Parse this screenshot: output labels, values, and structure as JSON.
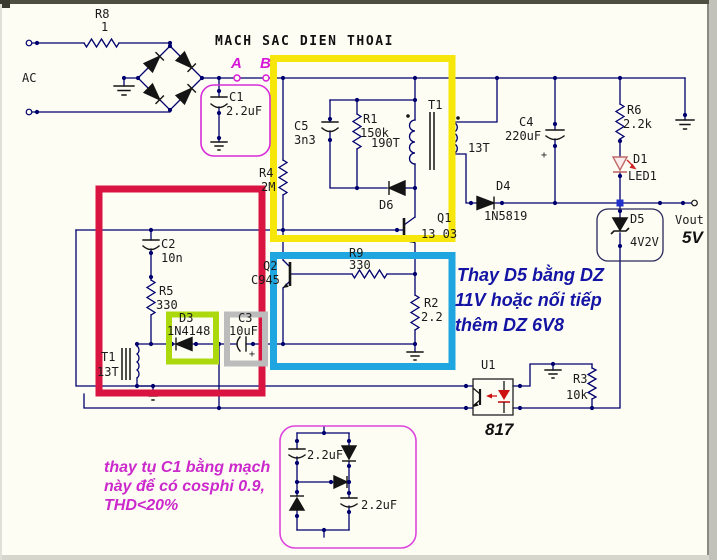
{
  "title": "MACH SAC DIEN THOAI",
  "labels": {
    "ac": "AC",
    "node_a": "A",
    "node_b": "B",
    "vout": "Vout",
    "vout_value": "5V"
  },
  "components": {
    "r8": {
      "ref": "R8",
      "value": "1"
    },
    "c1": {
      "ref": "C1",
      "value": "2.2uF"
    },
    "c5": {
      "ref": "C5",
      "value": "3n3"
    },
    "r1": {
      "ref": "R1",
      "value": "150k"
    },
    "r4": {
      "ref": "R4",
      "value": "2M"
    },
    "d6": {
      "ref": "D6"
    },
    "t1": {
      "ref": "T1",
      "primary_turns": "190T",
      "secondary_turns": "13T"
    },
    "q1": {
      "ref": "Q1",
      "part": "13 03"
    },
    "c4": {
      "ref": "C4",
      "value": "220uF",
      "polarity": "+"
    },
    "r6": {
      "ref": "R6",
      "value": "2.2k"
    },
    "d1": {
      "ref": "D1",
      "part": "LED1"
    },
    "d4": {
      "ref": "D4",
      "part": "1N5819"
    },
    "d5": {
      "ref": "D5",
      "part": "4V2V"
    },
    "c2": {
      "ref": "C2",
      "value": "10n"
    },
    "r5": {
      "ref": "R5",
      "value": "330"
    },
    "q2": {
      "ref": "Q2",
      "part": "C945"
    },
    "d3": {
      "ref": "D3",
      "part": "1N4148"
    },
    "c3": {
      "ref": "C3",
      "value": "10uF",
      "polarity": "+"
    },
    "t1_feedback": {
      "ref": "T1",
      "turns": "13T"
    },
    "r9": {
      "ref": "R9",
      "value": "330"
    },
    "r2": {
      "ref": "R2",
      "value": "2.2"
    },
    "u1": {
      "ref": "U1",
      "part": "817"
    },
    "r3": {
      "ref": "R3",
      "value": "10k"
    },
    "vf_cap_top": {
      "value": "2.2uF"
    },
    "vf_cap_bottom": {
      "value": "2.2uF"
    }
  },
  "annotations": {
    "blue_note": {
      "lines": [
        "Thay D5 bằng DZ",
        "11V hoặc nối tiếp",
        "thêm DZ 6V8"
      ],
      "color": "#1414a4"
    },
    "magenta_note": {
      "lines": [
        "thay tụ C1 bằng mạch",
        "này để có cosphi 0.9,",
        "THD<20%"
      ],
      "color": "#cc29cc"
    }
  },
  "colors": {
    "wire": "#00006e",
    "highlight_yellow": "#f6e60a",
    "highlight_red": "#da1440",
    "highlight_blue": "#1fa6e0",
    "highlight_green": "#abd90e",
    "highlight_gray": "#bcbcbc",
    "magenta_outline": "#d82cd8",
    "led_red": "#cc1111",
    "junction_blue": "#2233cc"
  }
}
